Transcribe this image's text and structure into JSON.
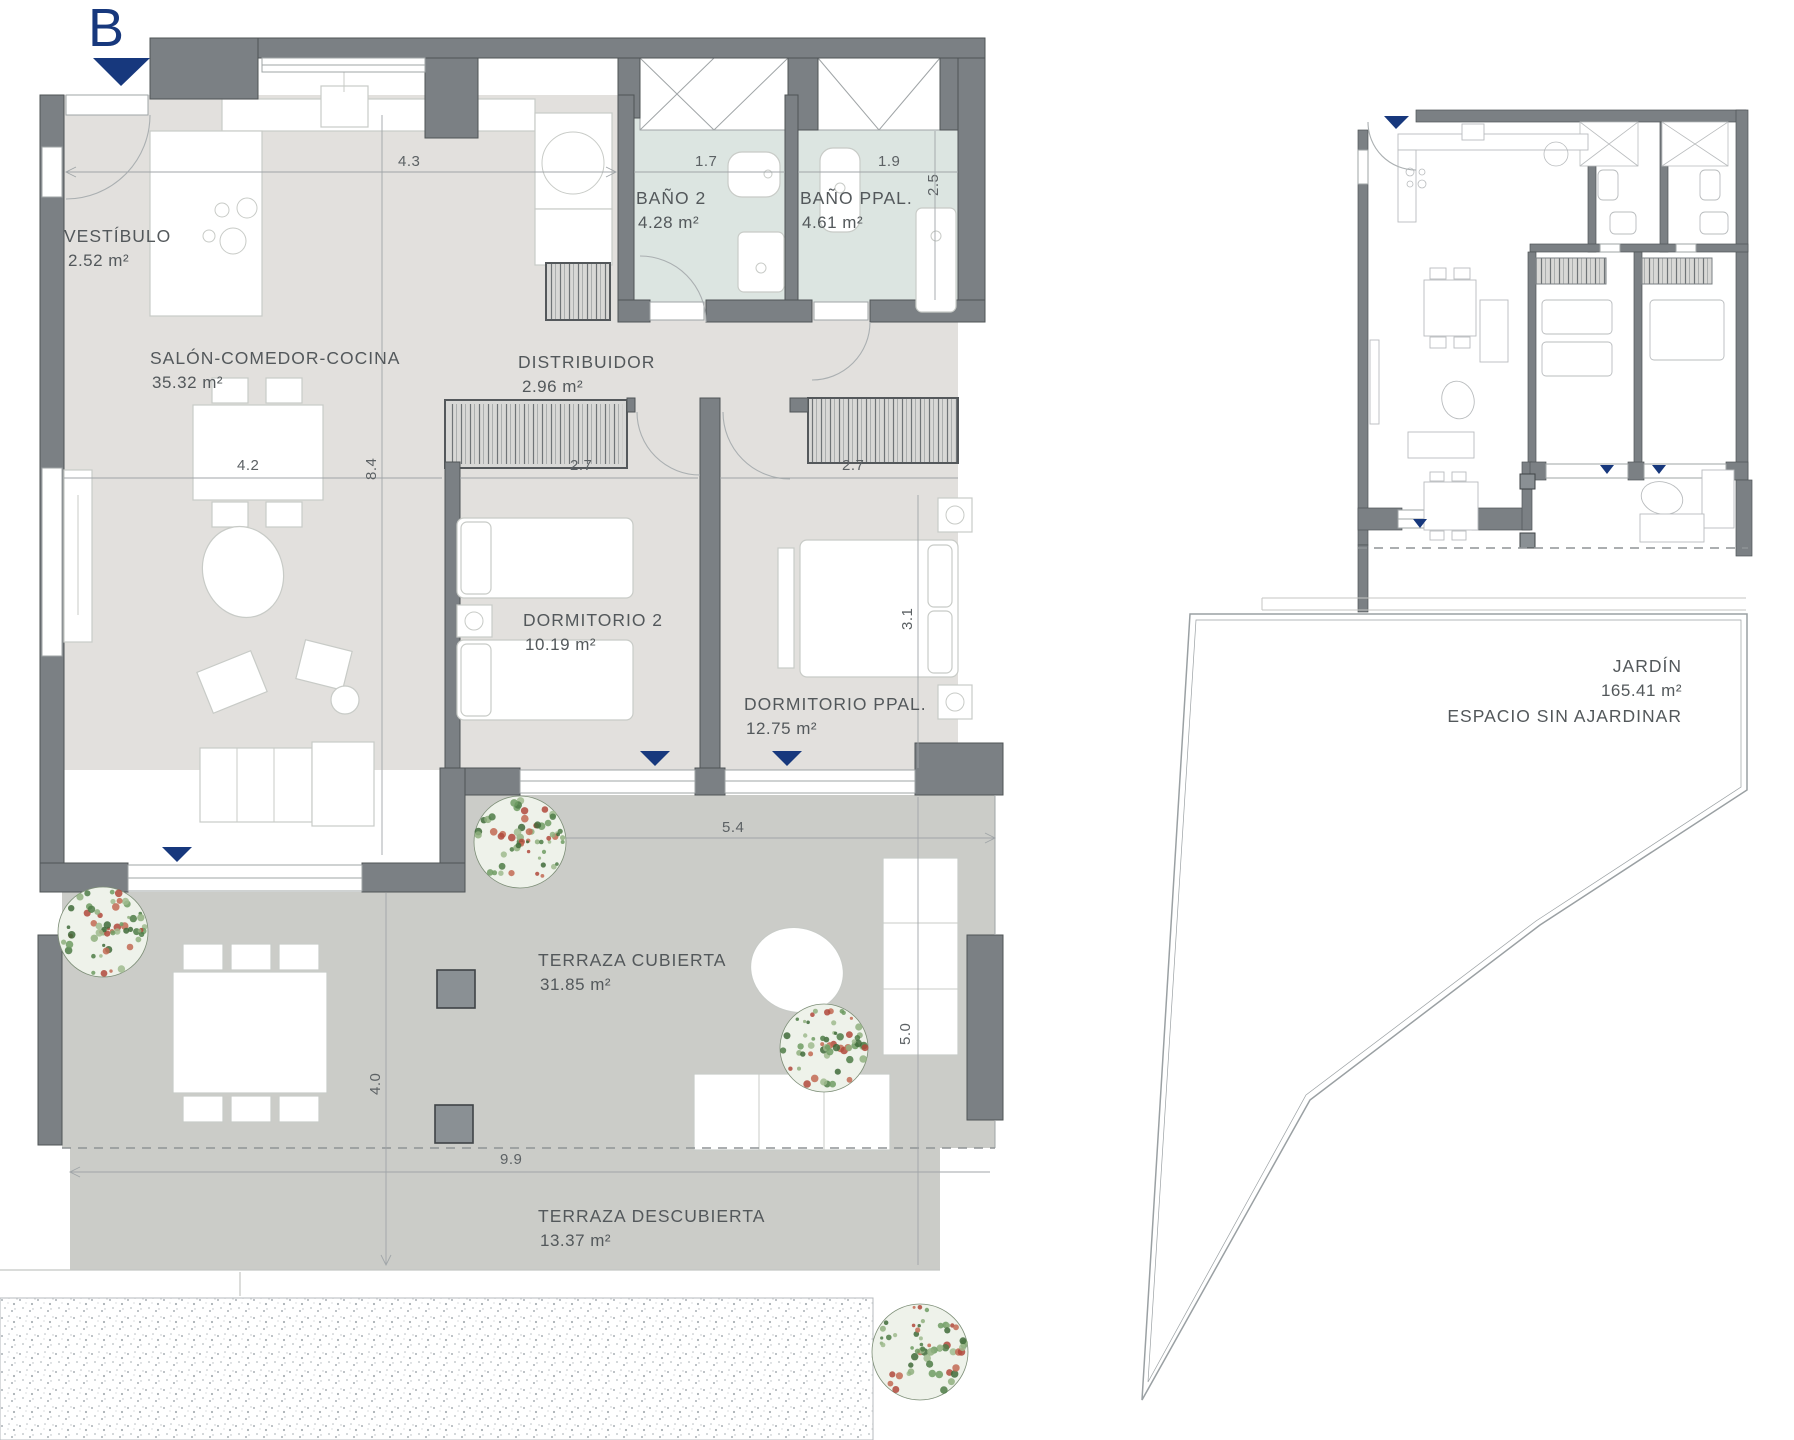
{
  "marker": {
    "label": "B"
  },
  "rooms": {
    "vestibulo": {
      "name": "VESTÍBULO",
      "area": "2.52 m²"
    },
    "salon": {
      "name": "SALÓN-COMEDOR-COCINA",
      "area": "35.32 m²"
    },
    "bano2": {
      "name": "BAÑO 2",
      "area": "4.28 m²"
    },
    "bano_ppal": {
      "name": "BAÑO PPAL.",
      "area": "4.61 m²"
    },
    "distribuidor": {
      "name": "DISTRIBUIDOR",
      "area": "2.96 m²"
    },
    "dormitorio2": {
      "name": "DORMITORIO 2",
      "area": "10.19 m²"
    },
    "dormitorio_ppal": {
      "name": "DORMITORIO PPAL.",
      "area": "12.75 m²"
    },
    "terraza_cubierta": {
      "name": "TERRAZA CUBIERTA",
      "area": "31.85 m²"
    },
    "terraza_descubierta": {
      "name": "TERRAZA DESCUBIERTA",
      "area": "13.37 m²"
    },
    "jardin": {
      "name": "JARDÍN",
      "area": "165.41 m²",
      "note": "ESPACIO SIN AJARDINAR"
    }
  },
  "dims": {
    "d43": "4.3",
    "d17": "1.7",
    "d19": "1.9",
    "d25": "2.5",
    "d42": "4.2",
    "d84": "8.4",
    "d27a": "2.7",
    "d27b": "2.7",
    "d31": "3.1",
    "d54": "5.4",
    "d50": "5.0",
    "d40": "4.0",
    "d99": "9.9"
  },
  "colors": {
    "accent_navy": "#17387d",
    "wall_gray": "#7b8084",
    "floor_interior": "#e2e0dd",
    "floor_bath": "#dce5e1",
    "floor_terrace": "#cbccc8"
  }
}
